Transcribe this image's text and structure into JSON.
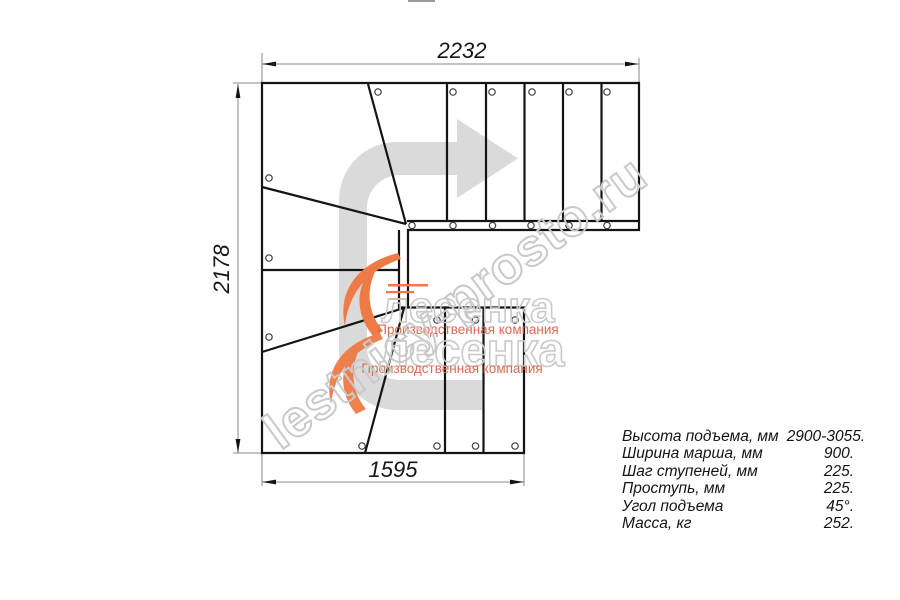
{
  "drawing": {
    "dim_top": "2232",
    "dim_left": "2178",
    "dim_bottom": "1595"
  },
  "specs": {
    "rows": [
      {
        "label": "Высота подъема, мм",
        "value": "2900-3055."
      },
      {
        "label": "Ширина марша, мм",
        "value": "900."
      },
      {
        "label": "Шаг ступеней, мм",
        "value": "225."
      },
      {
        "label": "Проступь, мм",
        "value": "225."
      },
      {
        "label": "Угол подъема",
        "value": "45°."
      },
      {
        "label": "Масса, кг",
        "value": "252."
      }
    ]
  },
  "watermark": {
    "diagonal_text": "lestnicy-prosto.ru",
    "logo_text": "лесенка",
    "logo_text2": "лесенка",
    "logo_subtitle": "Производственная компания",
    "logo_subtitle2": "Производственная компания"
  },
  "colors": {
    "line": "#141414",
    "dim_line": "#8a8a8a",
    "direction_arrow": "#dadada",
    "watermark_outline": "#c9c9c9",
    "logo_orange": "#ee7b45",
    "logo_red": "#dc6a52"
  }
}
